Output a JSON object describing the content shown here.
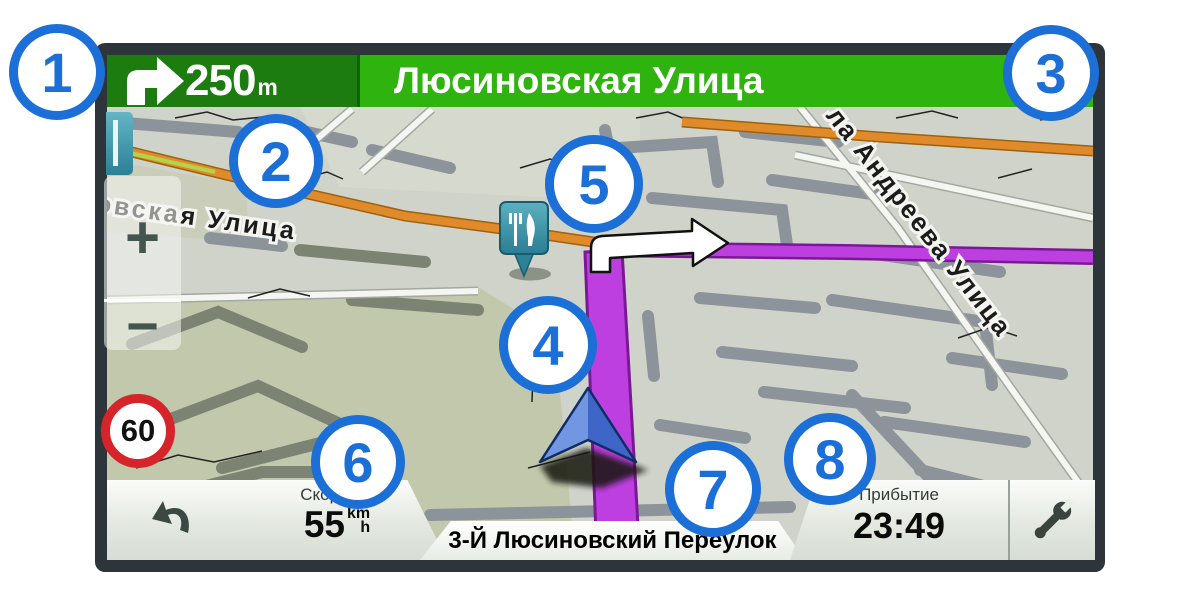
{
  "nav_bar": {
    "maneuver_icon": "turn-right-arrow",
    "distance": "250",
    "distance_unit": "m",
    "next_street": "Люсиновская Улица",
    "colors": {
      "left_bg": "#1d7c0f",
      "right_bg": "#2fb30f"
    }
  },
  "map": {
    "street_label_left": "овская Улица",
    "street_label_right": "ла Андреева Улица",
    "speed_limit": "60",
    "zoom_in": "+",
    "zoom_out": "−",
    "poi_icon": "restaurant-fork-knife",
    "vehicle_icon": "navigation-arrow",
    "route_color": "#bd3fe0",
    "highway_color": "#e18a29"
  },
  "status_bar": {
    "back_icon": "back-arrow",
    "speed_label": "Скорость",
    "speed_value": "55",
    "speed_unit_top": "km",
    "speed_unit_bottom": "h",
    "current_street": "3-Й Люсиновский Переулок",
    "arrival_label": "Прибытие",
    "arrival_value": "23:49",
    "tools_icon": "wrench"
  },
  "speed_sign": {
    "value": "60"
  },
  "callouts": [
    {
      "label": "1"
    },
    {
      "label": "2"
    },
    {
      "label": "3"
    },
    {
      "label": "4"
    },
    {
      "label": "5"
    },
    {
      "label": "6"
    },
    {
      "label": "7"
    },
    {
      "label": "8"
    }
  ],
  "callout_color": "#1c6fd6"
}
